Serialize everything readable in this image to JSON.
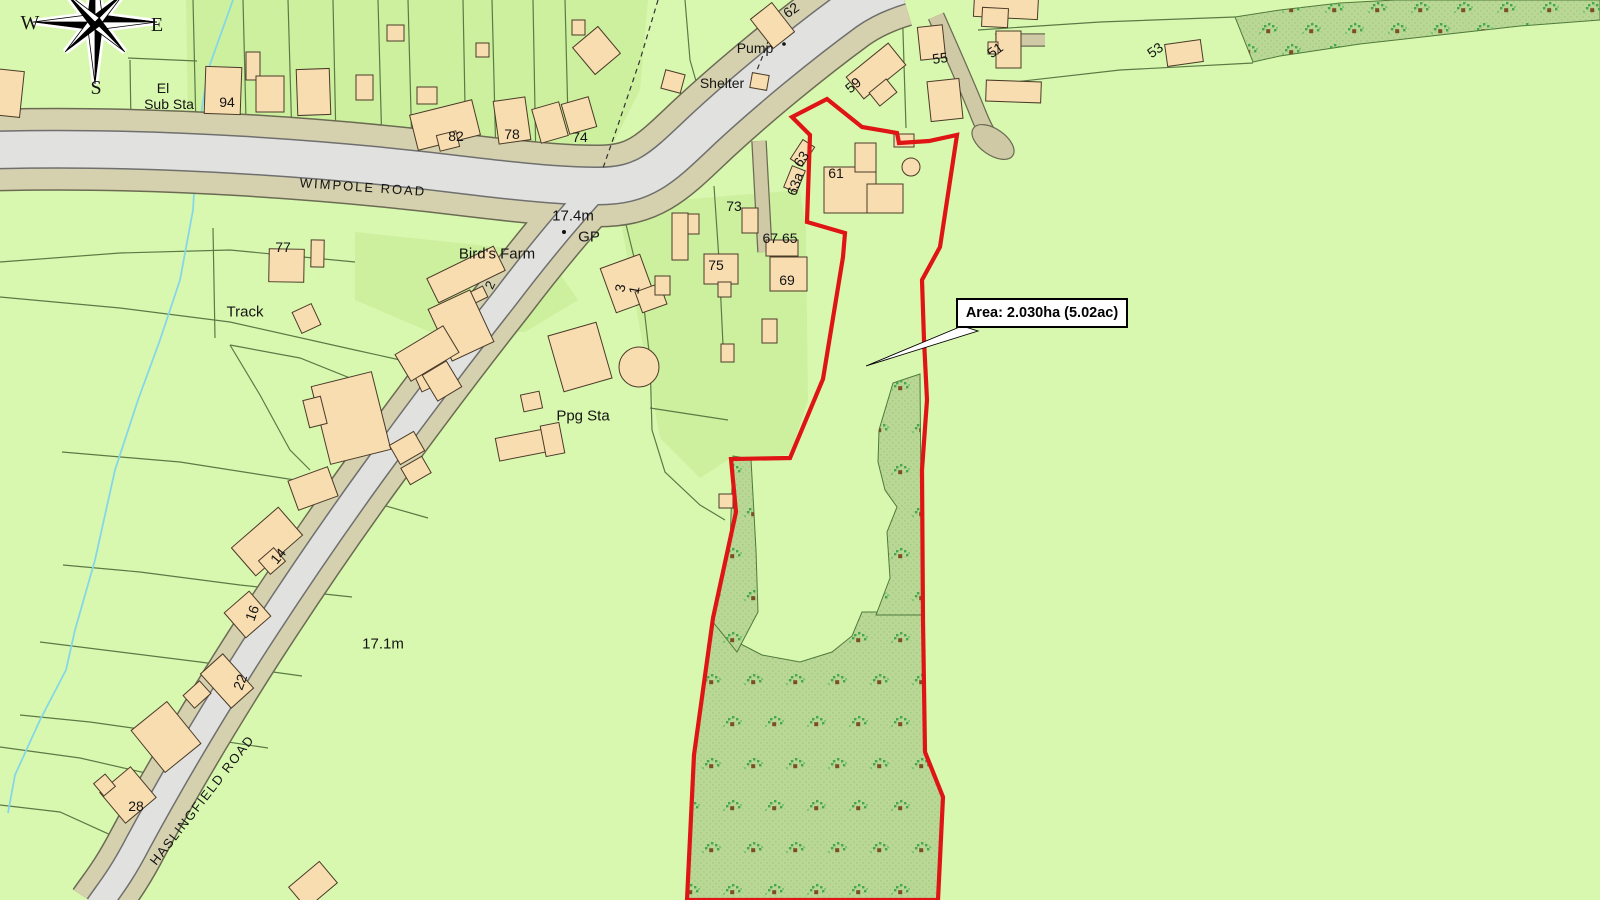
{
  "map_type": "land-registry-style site plan",
  "colors": {
    "field_green": "#d9f8af",
    "parcel_green_alt": "#cdf09e",
    "woodland_green": "#b9d795",
    "building_tan": "#f8ddb0",
    "road_grey": "#e1e1df",
    "road_verge_tan": "#d5d0ae",
    "boundary_red": "#df1515",
    "stream_blue": "#85d7e8",
    "field_line": "#5a7a46"
  },
  "compass": {
    "letters": [
      {
        "t": "W",
        "x": 30,
        "y": 23
      },
      {
        "t": "E",
        "x": 157,
        "y": 25
      },
      {
        "t": "S",
        "x": 96,
        "y": 88
      }
    ]
  },
  "labels": [
    {
      "t": "El",
      "x": 163,
      "y": 88,
      "fs": 14,
      "rot": 0,
      "ls": 0
    },
    {
      "t": "Sub Sta",
      "x": 169,
      "y": 104,
      "fs": 14,
      "rot": 0,
      "ls": 0
    },
    {
      "t": "94",
      "x": 227,
      "y": 102,
      "fs": 14,
      "rot": 0,
      "ls": 0
    },
    {
      "t": "82",
      "x": 456,
      "y": 136,
      "fs": 14,
      "rot": 0,
      "ls": 0
    },
    {
      "t": "78",
      "x": 512,
      "y": 134,
      "fs": 14,
      "rot": 0,
      "ls": 0
    },
    {
      "t": "74",
      "x": 580,
      "y": 137,
      "fs": 14,
      "rot": 0,
      "ls": 0
    },
    {
      "t": "62",
      "x": 791,
      "y": 10,
      "fs": 14,
      "rot": -35,
      "ls": 0
    },
    {
      "t": "Pump",
      "x": 755,
      "y": 48,
      "fs": 14,
      "rot": 0,
      "ls": 0
    },
    {
      "t": "Shelter",
      "x": 722,
      "y": 83,
      "fs": 14,
      "rot": 0,
      "ls": 0
    },
    {
      "t": "59",
      "x": 853,
      "y": 85,
      "fs": 14,
      "rot": -40,
      "ls": 0
    },
    {
      "t": "55",
      "x": 940,
      "y": 58,
      "fs": 14,
      "rot": -8,
      "ls": 0
    },
    {
      "t": "51",
      "x": 995,
      "y": 50,
      "fs": 14,
      "rot": -35,
      "ls": 0
    },
    {
      "t": "53",
      "x": 1155,
      "y": 50,
      "fs": 14,
      "rot": -35,
      "ls": 0
    },
    {
      "t": "61",
      "x": 836,
      "y": 173,
      "fs": 14,
      "rot": 0,
      "ls": 0
    },
    {
      "t": "63",
      "x": 801,
      "y": 159,
      "fs": 14,
      "rot": -55,
      "ls": 0
    },
    {
      "t": "63a",
      "x": 795,
      "y": 184,
      "fs": 14,
      "rot": -70,
      "ls": 0
    },
    {
      "t": "73",
      "x": 734,
      "y": 206,
      "fs": 14,
      "rot": 0,
      "ls": 0
    },
    {
      "t": "67 65",
      "x": 780,
      "y": 238,
      "fs": 14,
      "rot": 0,
      "ls": 0
    },
    {
      "t": "75",
      "x": 716,
      "y": 265,
      "fs": 14,
      "rot": 0,
      "ls": 0
    },
    {
      "t": "69",
      "x": 787,
      "y": 280,
      "fs": 14,
      "rot": 0,
      "ls": 0
    },
    {
      "t": "3",
      "x": 620,
      "y": 288,
      "fs": 14,
      "rot": -80,
      "ls": 0
    },
    {
      "t": "1",
      "x": 634,
      "y": 290,
      "fs": 14,
      "rot": -80,
      "ls": 0
    },
    {
      "t": "77",
      "x": 283,
      "y": 247,
      "fs": 14,
      "rot": 0,
      "ls": 0
    },
    {
      "t": "Bird's Farm",
      "x": 497,
      "y": 254,
      "fs": 15,
      "rot": 0,
      "ls": 0
    },
    {
      "t": "2",
      "x": 490,
      "y": 285,
      "fs": 13,
      "rot": -65,
      "ls": 0
    },
    {
      "t": "Track",
      "x": 245,
      "y": 312,
      "fs": 15,
      "rot": 0,
      "ls": 0
    },
    {
      "t": "Ppg Sta",
      "x": 583,
      "y": 416,
      "fs": 15,
      "rot": 0,
      "ls": 0
    },
    {
      "t": "14",
      "x": 278,
      "y": 556,
      "fs": 14,
      "rot": -50,
      "ls": 0
    },
    {
      "t": "16",
      "x": 252,
      "y": 613,
      "fs": 14,
      "rot": -70,
      "ls": 0
    },
    {
      "t": "22",
      "x": 240,
      "y": 682,
      "fs": 14,
      "rot": -70,
      "ls": 0
    },
    {
      "t": "28",
      "x": 136,
      "y": 806,
      "fs": 14,
      "rot": 0,
      "ls": 0
    },
    {
      "t": "17.4m",
      "x": 573,
      "y": 216,
      "fs": 15,
      "rot": 0,
      "ls": 0
    },
    {
      "t": "GP",
      "x": 589,
      "y": 237,
      "fs": 15,
      "rot": 0,
      "ls": 0
    },
    {
      "t": "17.1m",
      "x": 383,
      "y": 644,
      "fs": 15,
      "rot": 0,
      "ls": 0
    },
    {
      "t": "WIMPOLE ROAD",
      "x": 363,
      "y": 187,
      "fs": 13,
      "rot": 4,
      "ls": 2
    },
    {
      "t": "HASLINGFIELD ROAD",
      "x": 202,
      "y": 800,
      "fs": 13,
      "rot": -52,
      "ls": 1.5
    }
  ],
  "road_names": [
    "WIMPOLE ROAD",
    "HASLINGFIELD ROAD"
  ],
  "spot_heights": [
    "17.4m",
    "17.1m"
  ],
  "annotation": {
    "text": "Area: 2.030ha (5.02ac)"
  }
}
